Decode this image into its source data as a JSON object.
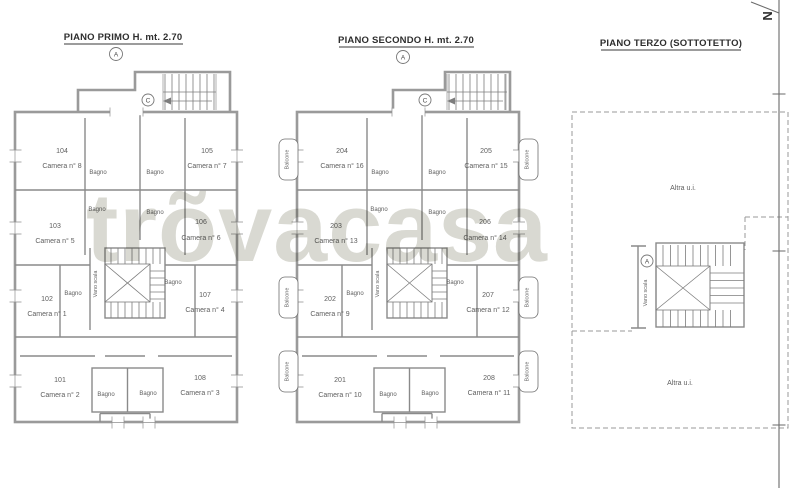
{
  "watermark": "trõvacasa",
  "north_label": "N",
  "plans": [
    {
      "title": "PIANO PRIMO H. mt. 2.70",
      "section_marker": "A",
      "stair_marker": "C",
      "stairwell_label": "Vano scala",
      "bath_label": "Bagno",
      "rooms": [
        {
          "code": "104",
          "name": "Camera n° 8"
        },
        {
          "code": "105",
          "name": "Camera n° 7"
        },
        {
          "code": "103",
          "name": "Camera n° 5"
        },
        {
          "code": "106",
          "name": "Camera n° 6"
        },
        {
          "code": "102",
          "name": "Camera n° 1"
        },
        {
          "code": "107",
          "name": "Camera n° 4"
        },
        {
          "code": "101",
          "name": "Camera n° 2"
        },
        {
          "code": "108",
          "name": "Camera n° 3"
        }
      ]
    },
    {
      "title": "PIANO SECONDO H. mt. 2.70",
      "section_marker": "A",
      "stair_marker": "C",
      "stairwell_label": "Vano scala",
      "bath_label": "Bagno",
      "balcony_label": "Balcone",
      "rooms": [
        {
          "code": "204",
          "name": "Camera n° 16"
        },
        {
          "code": "205",
          "name": "Camera n° 15"
        },
        {
          "code": "203",
          "name": "Camera n° 13"
        },
        {
          "code": "206",
          "name": "Camera n° 14"
        },
        {
          "code": "202",
          "name": "Camera n° 9"
        },
        {
          "code": "207",
          "name": "Camera n° 12"
        },
        {
          "code": "201",
          "name": "Camera n° 10"
        },
        {
          "code": "208",
          "name": "Camera n° 11"
        }
      ]
    },
    {
      "title": "PIANO TERZO (SOTTOTETTO)",
      "section_marker": "A",
      "stairwell_label": "Vano scala",
      "other_unit_label": "Altra u.i."
    }
  ]
}
